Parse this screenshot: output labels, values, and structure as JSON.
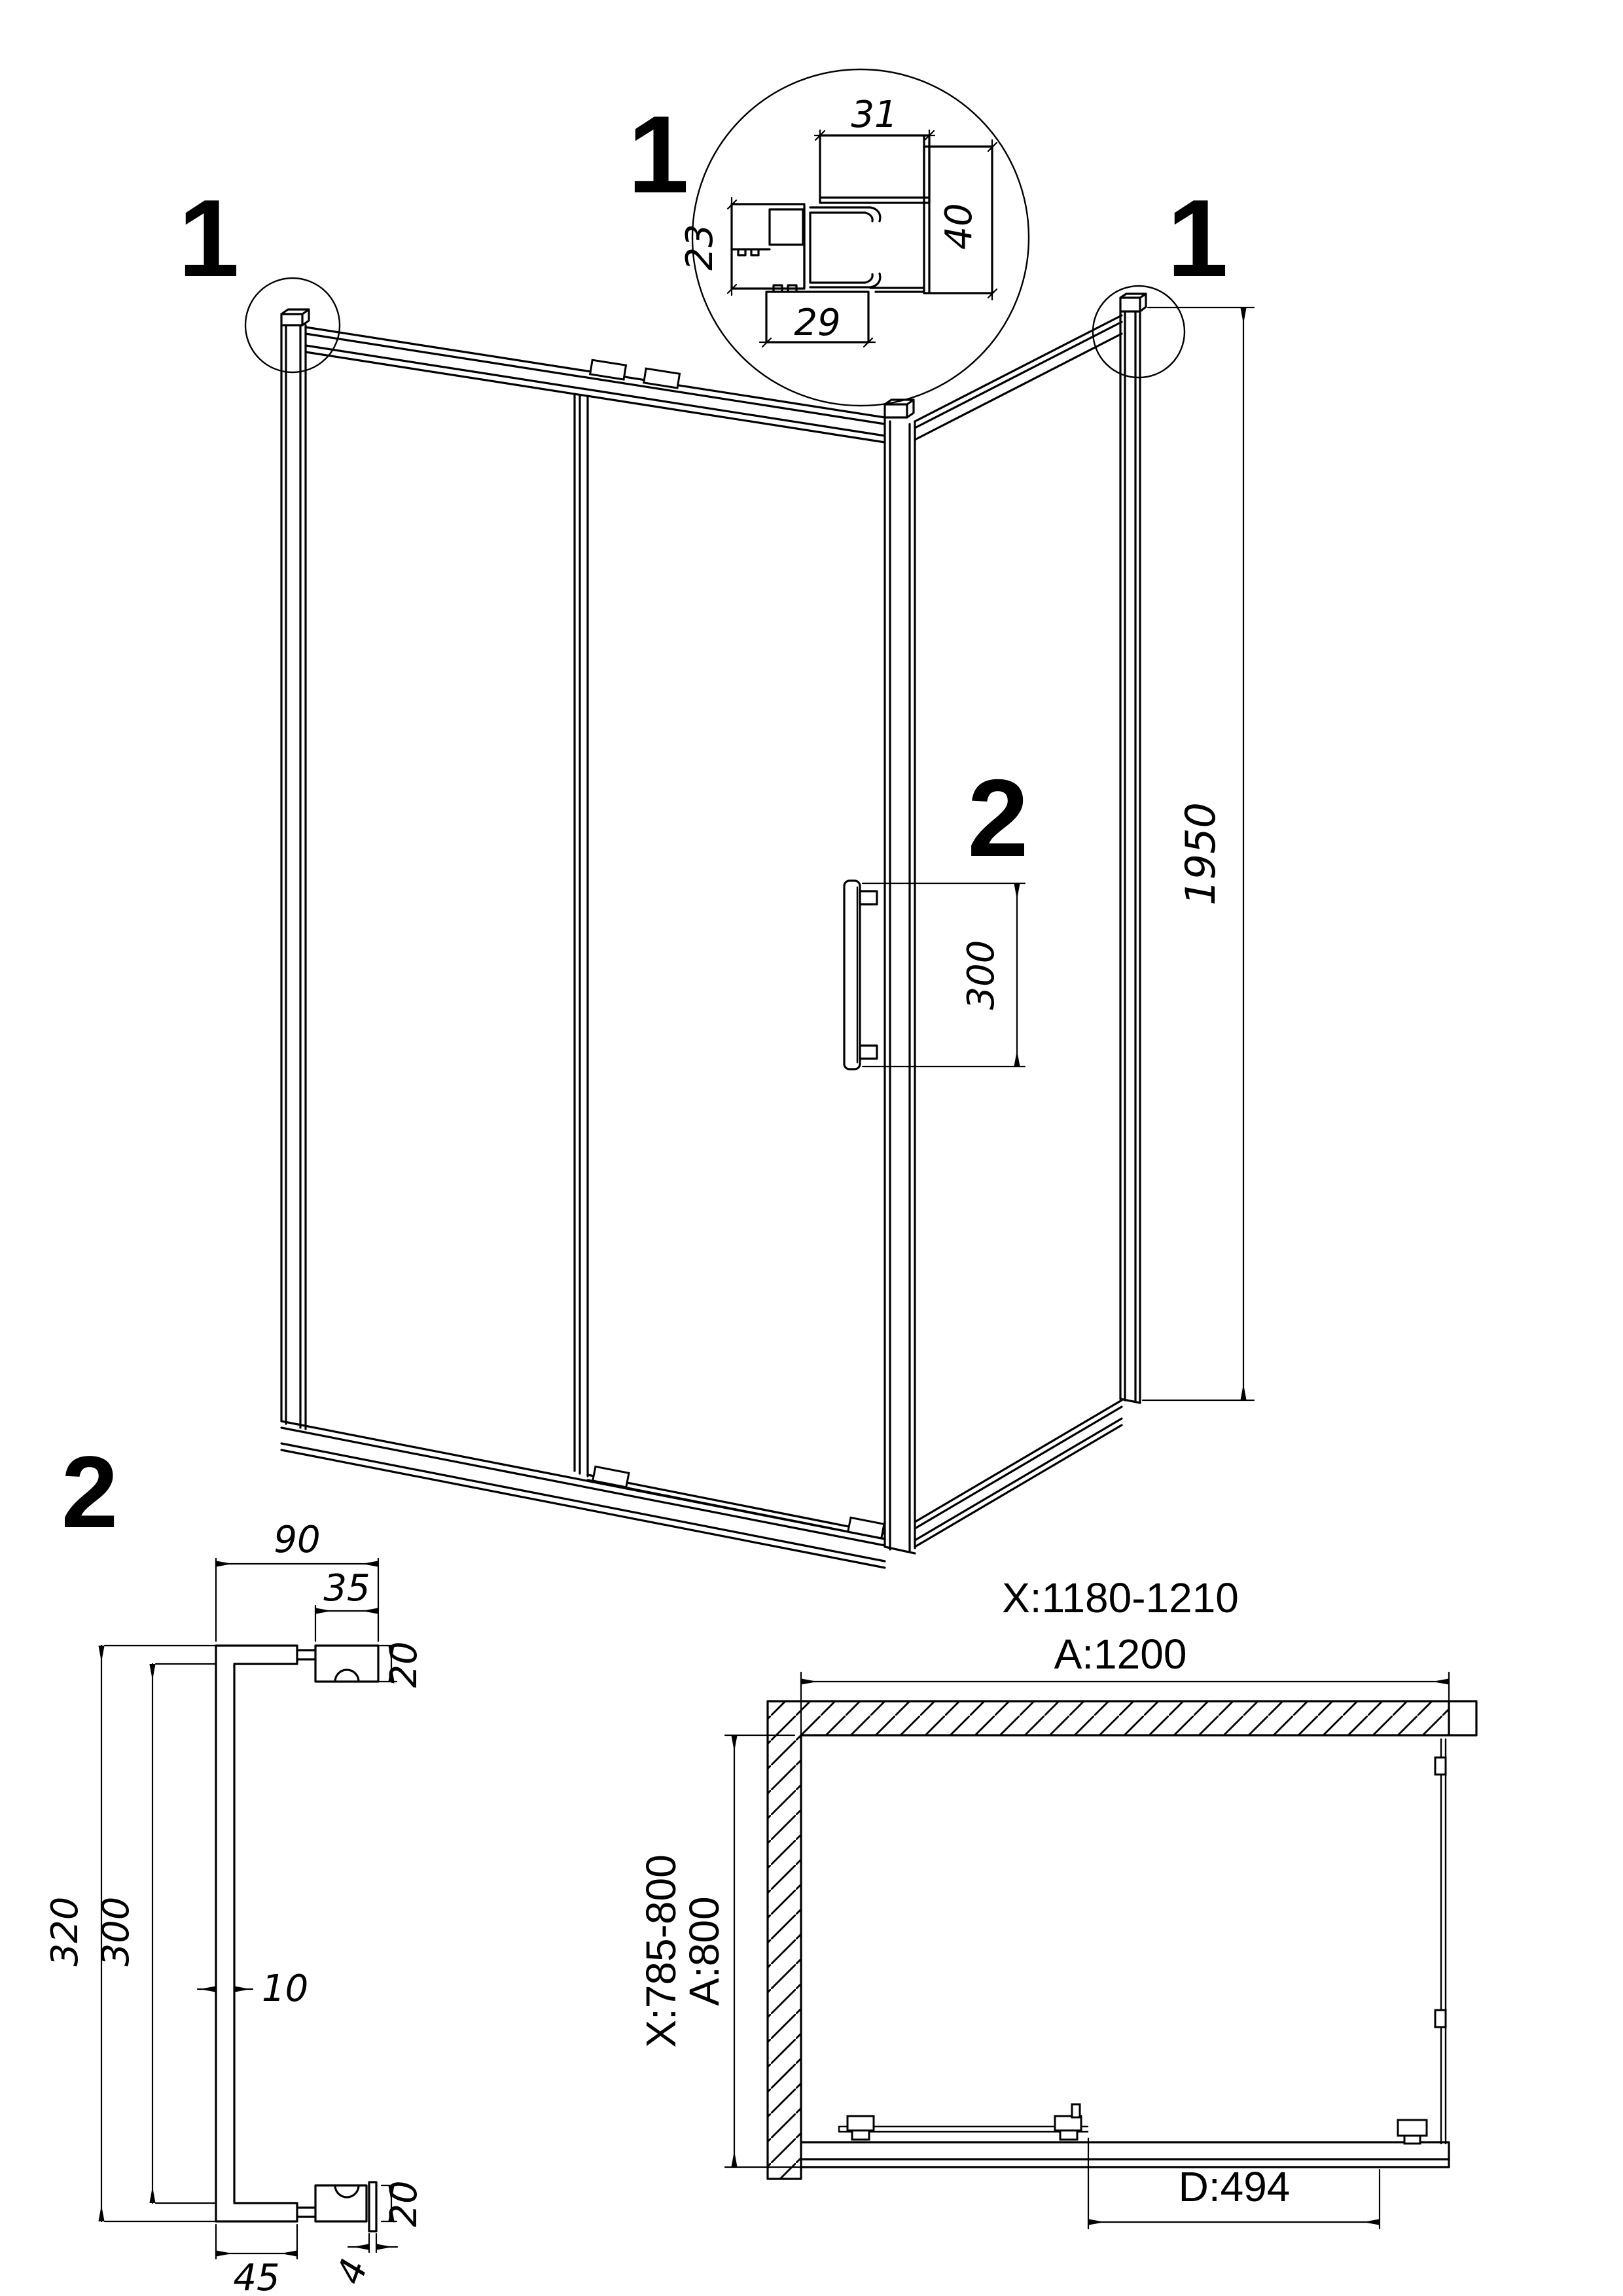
{
  "page": {
    "background": "#ffffff",
    "ink": "#000000"
  },
  "labels": {
    "detail1_marker": "1",
    "corner_left_marker": "1",
    "corner_right_marker": "1",
    "handle_marker": "2",
    "detail2_marker": "2"
  },
  "detail1": {
    "dims": {
      "top_width": "31",
      "right_height": "40",
      "left_height": "23",
      "bottom_width": "29"
    }
  },
  "main_view": {
    "dims": {
      "height": "1950",
      "handle_length": "300"
    }
  },
  "detail2": {
    "dims": {
      "overall_width": "90",
      "block_width": "35",
      "block_height_top": "20",
      "outer_length": "320",
      "inner_length": "300",
      "bar_thickness": "10",
      "block_height_bottom": "20",
      "plate_thickness": "4",
      "arm_length": "45"
    }
  },
  "plan_view": {
    "dims": {
      "width_range": "X:1180-1210",
      "width_nominal": "A:1200",
      "depth_range": "X:785-800",
      "depth_nominal": "A:800",
      "door_width": "D:494"
    }
  }
}
